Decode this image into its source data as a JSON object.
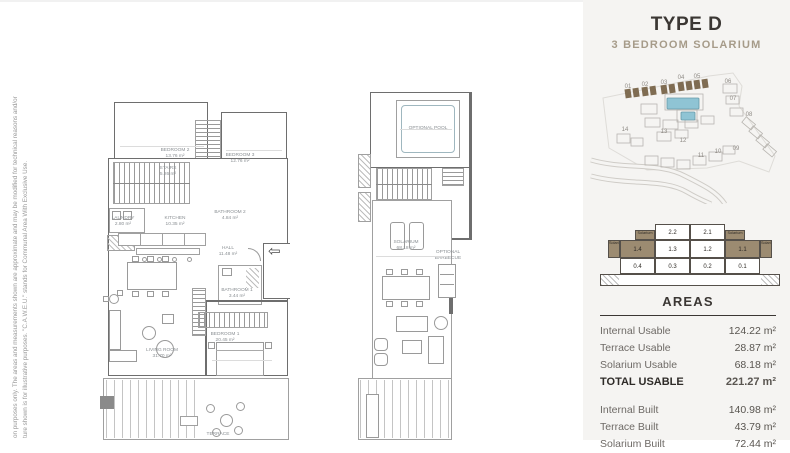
{
  "disclaimer": {
    "line1": "on purposes only. The areas and measurements shown are approximate and may be modified for technical reasons and/or",
    "line2": "ture shown is for illustrative purposes. \"C.A.W.E.U.\" stands for Communal Area With Exclusive Use."
  },
  "panel": {
    "title": "TYPE D",
    "subtitle": "3 BEDROOM SOLARIUM",
    "colors": {
      "panel_bg": "#f5f4f2",
      "title_text": "#3b3734",
      "subtitle_text": "#a69b89",
      "highlight_brown": "#9c8b71",
      "pool_blue": "#8fc4d4"
    },
    "sitemap": {
      "labels": [
        "01",
        "02",
        "03",
        "04",
        "05",
        "06",
        "07",
        "08",
        "09",
        "10",
        "11",
        "12",
        "13",
        "14"
      ]
    },
    "section": {
      "top_solarium_left": "Solarium",
      "unit_22": "2.2",
      "unit_21": "2.1",
      "top_solarium_right": "Solarium",
      "mid_solarium_left": "Solarium",
      "unit_14": "1.4",
      "unit_13": "1.3",
      "unit_12": "1.2",
      "unit_11": "1.1",
      "mid_solarium_right": "Solarium",
      "unit_04": "0.4",
      "unit_03": "0.3",
      "unit_02": "0.2",
      "unit_01": "0.1"
    },
    "areas": {
      "title": "AREAS",
      "usable": [
        {
          "label": "Internal Usable",
          "value": "124.22 m²"
        },
        {
          "label": "Terrace Usable",
          "value": "28.87 m²"
        },
        {
          "label": "Solarium Usable",
          "value": "68.18 m²"
        }
      ],
      "total": {
        "label": "TOTAL USABLE",
        "value": "221.27 m²"
      },
      "built": [
        {
          "label": "Internal Built",
          "value": "140.98 m²"
        },
        {
          "label": "Terrace Built",
          "value": "43.79 m²"
        },
        {
          "label": "Solarium Built",
          "value": "72.44 m²"
        }
      ]
    }
  },
  "floor_main": {
    "rooms": {
      "bedroom2": {
        "name": "BEDROOM 2",
        "area": "13.76 m²"
      },
      "bedroom3": {
        "name": "BEDROOM 3",
        "area": "12.76 m²"
      },
      "stairs": {
        "name": "STAIRS",
        "area": "5.26 m²"
      },
      "bathroom2": {
        "name": "BATHROOM 2",
        "area": "4.84 m²"
      },
      "laundry": {
        "name": "LAUNDRY",
        "area": "2.80 m²"
      },
      "kitchen": {
        "name": "KITCHEN",
        "area": "10.35 m²"
      },
      "hall": {
        "name": "HALL",
        "area": "11.48 m²"
      },
      "bathroom1": {
        "name": "BATHROOM 1",
        "area": "3.44 m²"
      },
      "living": {
        "name": "LIVING ROOM",
        "area": "31.70 m²"
      },
      "bedroom1": {
        "name": "BEDROOM 1",
        "area": "20.45 m²"
      },
      "terrace": {
        "name": "TERRACE",
        "area": "28.87 m²"
      }
    }
  },
  "floor_solarium": {
    "labels": {
      "pool": {
        "name": "OPTIONAL POOL"
      },
      "solarium": {
        "name": "SOLARIUM",
        "area": "68.18 m²"
      },
      "barbecue": {
        "line1": "OPTIONAL",
        "line2": "BARBECUE"
      }
    }
  }
}
